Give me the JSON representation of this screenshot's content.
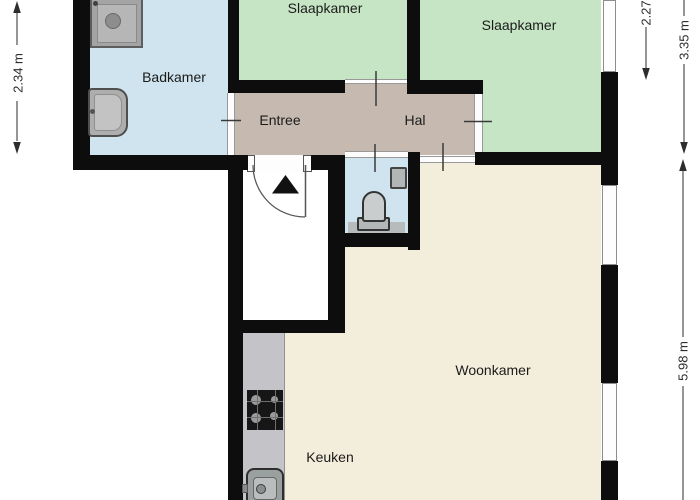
{
  "rooms": {
    "badkamer": {
      "label": "Badkamer"
    },
    "slaapkamer_links": {
      "label": "Slaapkamer"
    },
    "slaapkamer_rechts": {
      "label": "Slaapkamer"
    },
    "entree": {
      "label": "Entree"
    },
    "hal": {
      "label": "Hal"
    },
    "woonkamer": {
      "label": "Woonkamer"
    },
    "keuken": {
      "label": "Keuken"
    }
  },
  "dimensions": {
    "left_height": "2.34 m",
    "right_top": "2.27",
    "right_upper": "3.35 m",
    "right_lower": "5.98 m"
  },
  "colors": {
    "wall": "#0d0d0d",
    "wet_room": "#cfe4ee",
    "bedroom": "#c6e5c4",
    "hallway": "#c6bab0",
    "living": "#f3eddb",
    "outside": "#ffffff",
    "dimension": "#2d2d2d",
    "counter": "#c4c4c8"
  },
  "icons": [
    "shower-icon",
    "washbasin-icon",
    "toilet-icon",
    "hand-basin-icon",
    "bath-mat-icon",
    "cooktop-icon",
    "kitchen-sink-icon",
    "kitchen-counter",
    "entrance-arrow-icon",
    "door-swing-icon",
    "window-icon",
    "door-opening-icon",
    "dimension-arrow-icon"
  ]
}
